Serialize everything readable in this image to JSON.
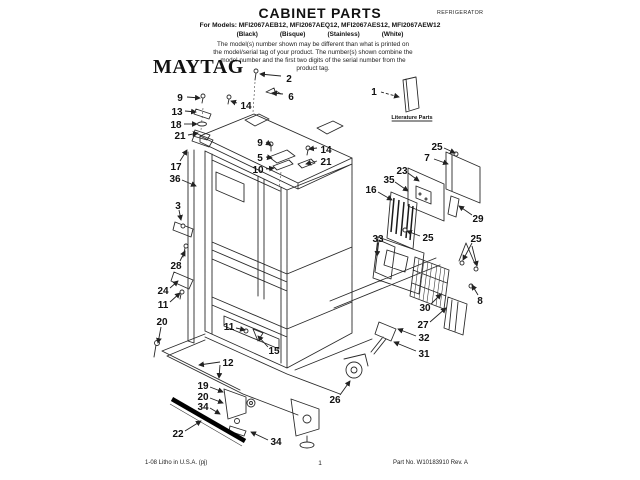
{
  "header": {
    "title": "CABINET PARTS",
    "doc_type": "REFRIGERATOR",
    "models_line": "For Models: MFI2067AEB12, MFI2067AEQ12, MFI2067AES12, MFI2067AEW12",
    "colors": [
      "(Black)",
      "(Bisque)",
      "(Stainless)",
      "(White)"
    ],
    "note": "The model(s) number shown may be different than what is printed on the model/serial tag of your product. The number(s) shown combine the model number and the first two digits of the serial number from the product tag."
  },
  "brand": {
    "logo": "MAYTAG"
  },
  "diagram": {
    "literature_label": "Literature Parts",
    "callouts": [
      {
        "t": "2",
        "x": 289,
        "y": 79,
        "lx": 281,
        "ly": 76,
        "tx": 260,
        "ty": 74
      },
      {
        "t": "6",
        "x": 291,
        "y": 97,
        "lx": 283,
        "ly": 94,
        "tx": 272,
        "ty": 93
      },
      {
        "t": "14",
        "x": 246,
        "y": 106,
        "lx": 237,
        "ly": 103,
        "tx": 231,
        "ty": 101
      },
      {
        "t": "9",
        "x": 180,
        "y": 98,
        "lx": 187,
        "ly": 97,
        "tx": 200,
        "ty": 98
      },
      {
        "t": "13",
        "x": 177,
        "y": 112,
        "lx": 185,
        "ly": 111,
        "tx": 196,
        "ty": 112
      },
      {
        "t": "18",
        "x": 176,
        "y": 125,
        "lx": 184,
        "ly": 124,
        "tx": 197,
        "ty": 124
      },
      {
        "t": "21",
        "x": 180,
        "y": 136,
        "lx": 188,
        "ly": 135,
        "tx": 198,
        "ty": 133
      },
      {
        "t": "17",
        "x": 176,
        "y": 167,
        "lx": 180,
        "ly": 161,
        "tx": 187,
        "ty": 150
      },
      {
        "t": "36",
        "x": 175,
        "y": 179,
        "lx": 182,
        "ly": 180,
        "tx": 196,
        "ty": 186
      },
      {
        "t": "9",
        "x": 260,
        "y": 143,
        "lx": 266,
        "ly": 142,
        "tx": 271,
        "ty": 145
      },
      {
        "t": "5",
        "x": 260,
        "y": 158,
        "lx": 266,
        "ly": 157,
        "tx": 272,
        "ty": 158
      },
      {
        "t": "10",
        "x": 258,
        "y": 170,
        "lx": 266,
        "ly": 169,
        "tx": 274,
        "ty": 168
      },
      {
        "t": "14",
        "x": 326,
        "y": 150,
        "lx": 317,
        "ly": 148,
        "tx": 309,
        "ty": 149
      },
      {
        "t": "21",
        "x": 326,
        "y": 162,
        "lx": 317,
        "ly": 161,
        "tx": 306,
        "ty": 164
      },
      {
        "t": "1",
        "x": 374,
        "y": 92,
        "lx": 381,
        "ly": 92,
        "tx": 399,
        "ty": 97,
        "dashed": true
      },
      {
        "t": "25",
        "x": 437,
        "y": 147,
        "lx": 444,
        "ly": 148,
        "tx": 455,
        "ty": 153
      },
      {
        "t": "7",
        "x": 427,
        "y": 158,
        "lx": 434,
        "ly": 159,
        "tx": 448,
        "ty": 164
      },
      {
        "t": "23",
        "x": 402,
        "y": 171,
        "lx": 408,
        "ly": 173,
        "tx": 419,
        "ty": 181
      },
      {
        "t": "35",
        "x": 389,
        "y": 180,
        "lx": 395,
        "ly": 182,
        "tx": 408,
        "ty": 191
      },
      {
        "t": "16",
        "x": 371,
        "y": 190,
        "lx": 378,
        "ly": 192,
        "tx": 392,
        "ty": 200
      },
      {
        "t": "29",
        "x": 478,
        "y": 219,
        "lx": 472,
        "ly": 215,
        "tx": 459,
        "ty": 206
      },
      {
        "t": "33",
        "x": 378,
        "y": 239,
        "lx": 378,
        "ly": 243,
        "tx": 377,
        "ty": 256
      },
      {
        "t": "25",
        "x": 428,
        "y": 238,
        "lx": 420,
        "ly": 236,
        "tx": 407,
        "ty": 231
      },
      {
        "t": "25",
        "x": 476,
        "y": 239,
        "lx": 472,
        "ly": 243,
        "tx": 463,
        "ty": 260,
        "t2x": 477,
        "t2y": 266
      },
      {
        "t": "8",
        "x": 480,
        "y": 301,
        "lx": 478,
        "ly": 295,
        "tx": 472,
        "ty": 285
      },
      {
        "t": "30",
        "x": 425,
        "y": 308,
        "lx": 431,
        "ly": 304,
        "tx": 441,
        "ty": 294
      },
      {
        "t": "27",
        "x": 423,
        "y": 325,
        "lx": 430,
        "ly": 322,
        "tx": 446,
        "ty": 308
      },
      {
        "t": "32",
        "x": 424,
        "y": 338,
        "lx": 416,
        "ly": 336,
        "tx": 398,
        "ty": 329
      },
      {
        "t": "31",
        "x": 424,
        "y": 354,
        "lx": 416,
        "ly": 351,
        "tx": 394,
        "ty": 342
      },
      {
        "t": "26",
        "x": 335,
        "y": 400,
        "lx": 340,
        "ly": 395,
        "tx": 350,
        "ty": 381
      },
      {
        "t": "3",
        "x": 178,
        "y": 206,
        "lx": 179,
        "ly": 210,
        "tx": 181,
        "ty": 220
      },
      {
        "t": "28",
        "x": 176,
        "y": 266,
        "lx": 180,
        "ly": 261,
        "tx": 185,
        "ty": 251
      },
      {
        "t": "24",
        "x": 163,
        "y": 291,
        "lx": 170,
        "ly": 288,
        "tx": 178,
        "ty": 281
      },
      {
        "t": "11",
        "x": 163,
        "y": 305,
        "lx": 170,
        "ly": 302,
        "tx": 180,
        "ty": 293
      },
      {
        "t": "20",
        "x": 162,
        "y": 322,
        "lx": 161,
        "ly": 327,
        "tx": 158,
        "ty": 343
      },
      {
        "t": "11",
        "x": 229,
        "y": 327,
        "lx": 236,
        "ly": 328,
        "tx": 245,
        "ty": 330
      },
      {
        "t": "15",
        "x": 274,
        "y": 351,
        "lx": 268,
        "ly": 347,
        "tx": 258,
        "ty": 336
      },
      {
        "t": "12",
        "x": 228,
        "y": 363,
        "lx": 220,
        "ly": 362,
        "tx": 199,
        "ty": 365,
        "t2x": 219,
        "t2y": 378
      },
      {
        "t": "19",
        "x": 203,
        "y": 386,
        "lx": 210,
        "ly": 387,
        "tx": 223,
        "ty": 392
      },
      {
        "t": "20",
        "x": 203,
        "y": 397,
        "lx": 210,
        "ly": 398,
        "tx": 223,
        "ty": 403
      },
      {
        "t": "34",
        "x": 203,
        "y": 407,
        "lx": 210,
        "ly": 408,
        "tx": 220,
        "ty": 414
      },
      {
        "t": "22",
        "x": 178,
        "y": 434,
        "lx": 185,
        "ly": 431,
        "tx": 201,
        "ty": 421
      },
      {
        "t": "34",
        "x": 276,
        "y": 442,
        "lx": 268,
        "ly": 440,
        "tx": 251,
        "ty": 432
      }
    ]
  },
  "footer": {
    "left": "1-08 Litho in U.S.A. (pj)",
    "page": "1",
    "right": "Part No. W10183910 Rev. A"
  }
}
